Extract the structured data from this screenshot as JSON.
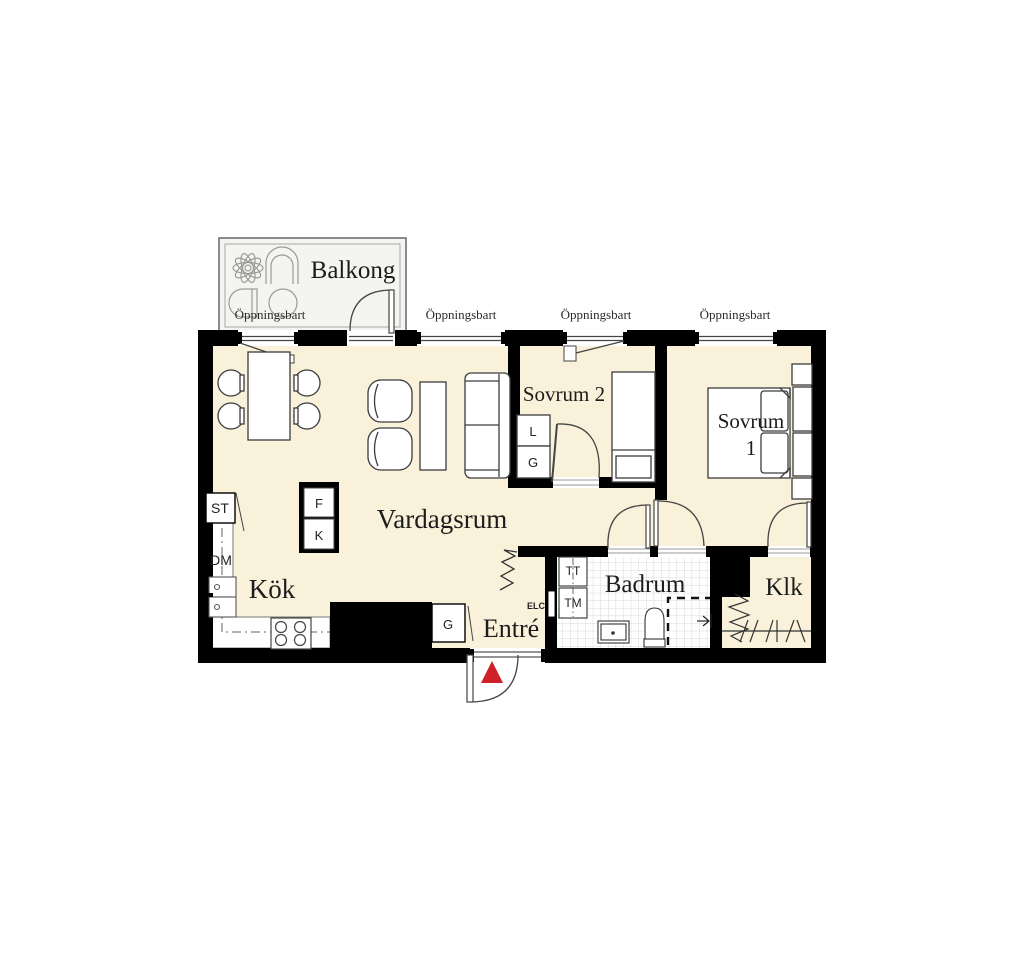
{
  "plan": {
    "rooms": {
      "balkong": "Balkong",
      "vardagsrum": "Vardagsrum",
      "kok": "Kök",
      "entre": "Entré",
      "badrum": "Badrum",
      "klk": "Klk",
      "sovrum2": "Sovrum 2",
      "sovrum1_line1": "Sovrum",
      "sovrum1_line2": "1"
    },
    "window_label": "Öppningsbart",
    "appliances": {
      "st": "ST",
      "dm": "DM",
      "f": "F",
      "k": "K",
      "l": "L",
      "g": "G",
      "tt": "TT",
      "tm": "TM",
      "elc": "ELC"
    },
    "colors": {
      "floor": "#faf1da",
      "balcony_floor": "#f4f4f1",
      "wall": "#000000",
      "entry_arrow": "#cf2127",
      "tile_line": "#d8d8d8"
    }
  }
}
